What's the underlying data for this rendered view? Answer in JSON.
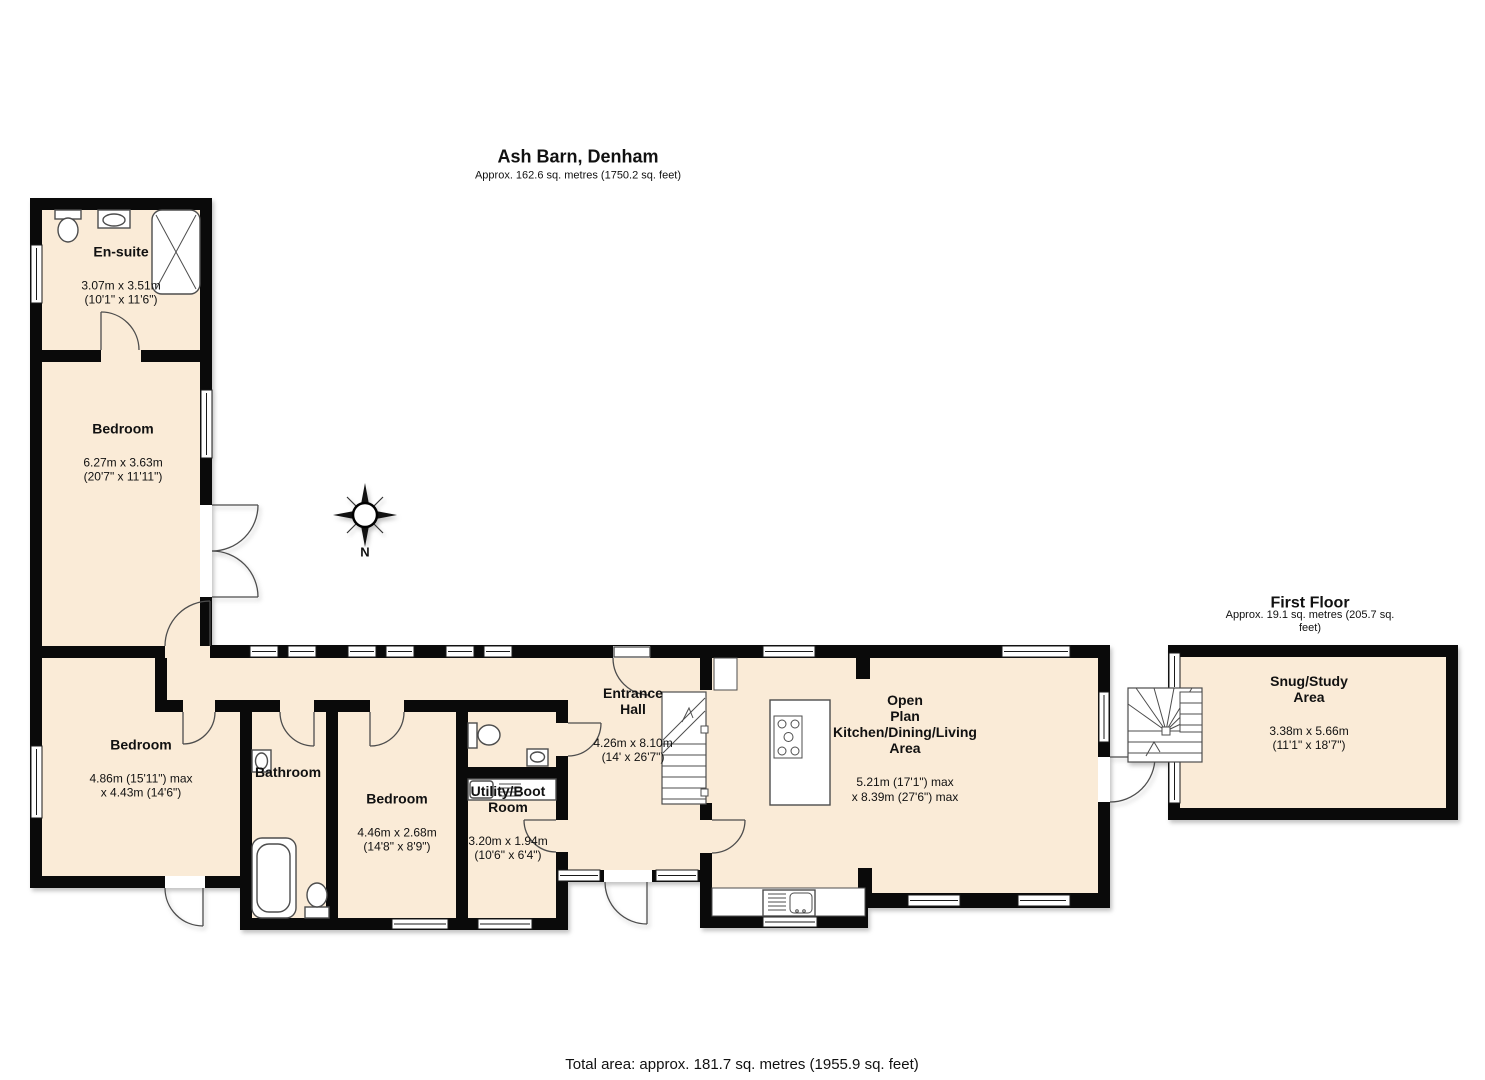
{
  "page": {
    "title": "Ash Barn, Denham",
    "subtitle": "Approx. 162.6 sq. metres (1750.2 sq. feet)",
    "footer": "Total area: approx. 181.7 sq. metres (1955.9 sq. feet)"
  },
  "first_floor": {
    "title": "First Floor",
    "subtitle": "Approx. 19.1 sq. metres (205.7 sq. feet)"
  },
  "compass": {
    "north_label": "N"
  },
  "colors": {
    "floor_fill": "#FAEBD7",
    "wall": "#0a0a0a",
    "line": "#4d4d4d"
  },
  "rooms": {
    "ensuite": {
      "name": "En-suite",
      "dims": "3.07m x 3.51m\n(10'1\" x 11'6\")"
    },
    "bedroom_top": {
      "name": "Bedroom",
      "dims": "6.27m x 3.63m\n(20'7\" x 11'11\")"
    },
    "bedroom_left": {
      "name": "Bedroom",
      "dims": "4.86m (15'11\") max\nx 4.43m (14'6\")"
    },
    "bathroom": {
      "name": "Bathroom"
    },
    "bedroom_mid": {
      "name": "Bedroom",
      "dims": "4.46m x 2.68m\n(14'8\" x 8'9\")"
    },
    "utility": {
      "name": "Utility/Boot\nRoom",
      "dims": "3.20m x 1.94m\n(10'6\" x 6'4\")"
    },
    "hall": {
      "name": "Entrance\nHall",
      "dims": "4.26m x 8.10m\n(14' x 26'7\")"
    },
    "open_plan": {
      "name": "Open\nPlan\nKitchen/Dining/Living\nArea",
      "dims": "5.21m (17'1\") max\nx 8.39m (27'6\") max"
    },
    "snug": {
      "name": "Snug/Study\nArea",
      "dims": "3.38m x 5.66m\n(11'1\" x 18'7\")"
    }
  }
}
